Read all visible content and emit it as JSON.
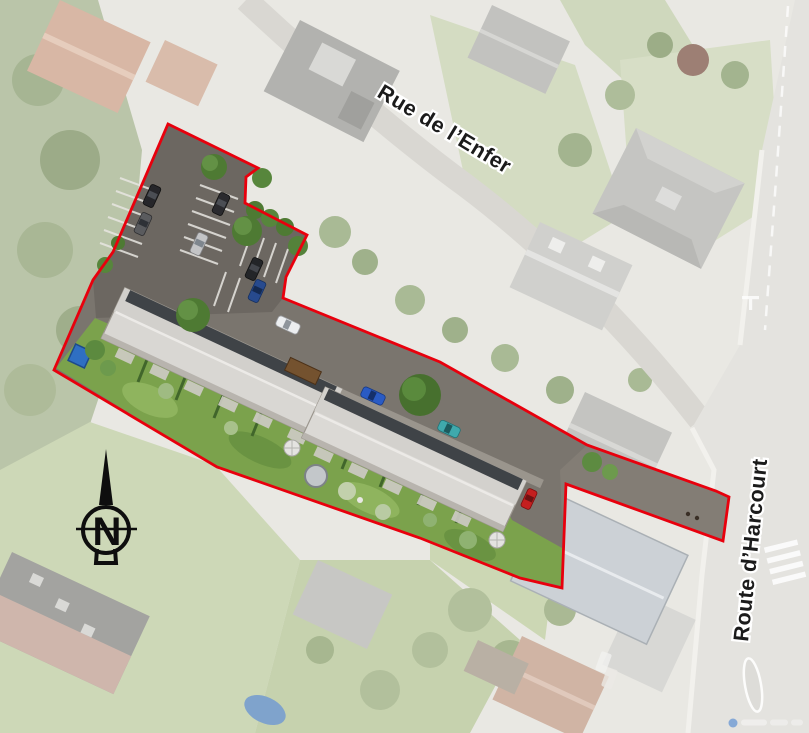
{
  "map": {
    "type": "aerial-site-plan",
    "streets": [
      {
        "label": "Rue de l’Enfer"
      },
      {
        "label": "Route d’Harcourt"
      }
    ],
    "compass": {
      "north_label": "N"
    },
    "site_boundary": {
      "color": "#e8000d",
      "style": "solid"
    },
    "watermark": {
      "dot_color": "#3a7ad0"
    }
  }
}
